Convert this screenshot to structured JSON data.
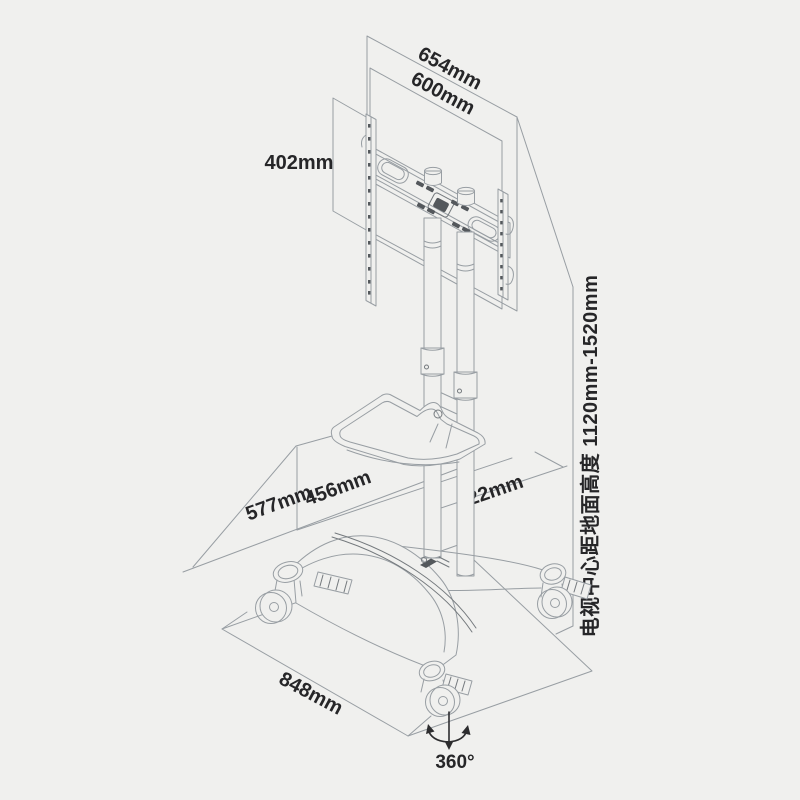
{
  "diagram": {
    "labels": {
      "tv_outer_width": "654mm",
      "tv_vesa_width": "600mm",
      "bracket_height": "402mm",
      "tv_center_height": "电视中心距地面高度 1120mm-1520mm",
      "base_depth_outer": "577mm",
      "shelf_width": "456mm",
      "base_depth_inner": "322mm",
      "base_width": "848mm",
      "caster_rotation": "360°"
    },
    "icons": {
      "rotation_arrow": "rotation-arrow-icon"
    },
    "colors": {
      "background": "#f0f0ee",
      "line": "#989ea3",
      "line_dark": "#74797d",
      "detail_fill": "#54585c",
      "annotation": "#2d2d2f",
      "text": "#262628"
    }
  }
}
